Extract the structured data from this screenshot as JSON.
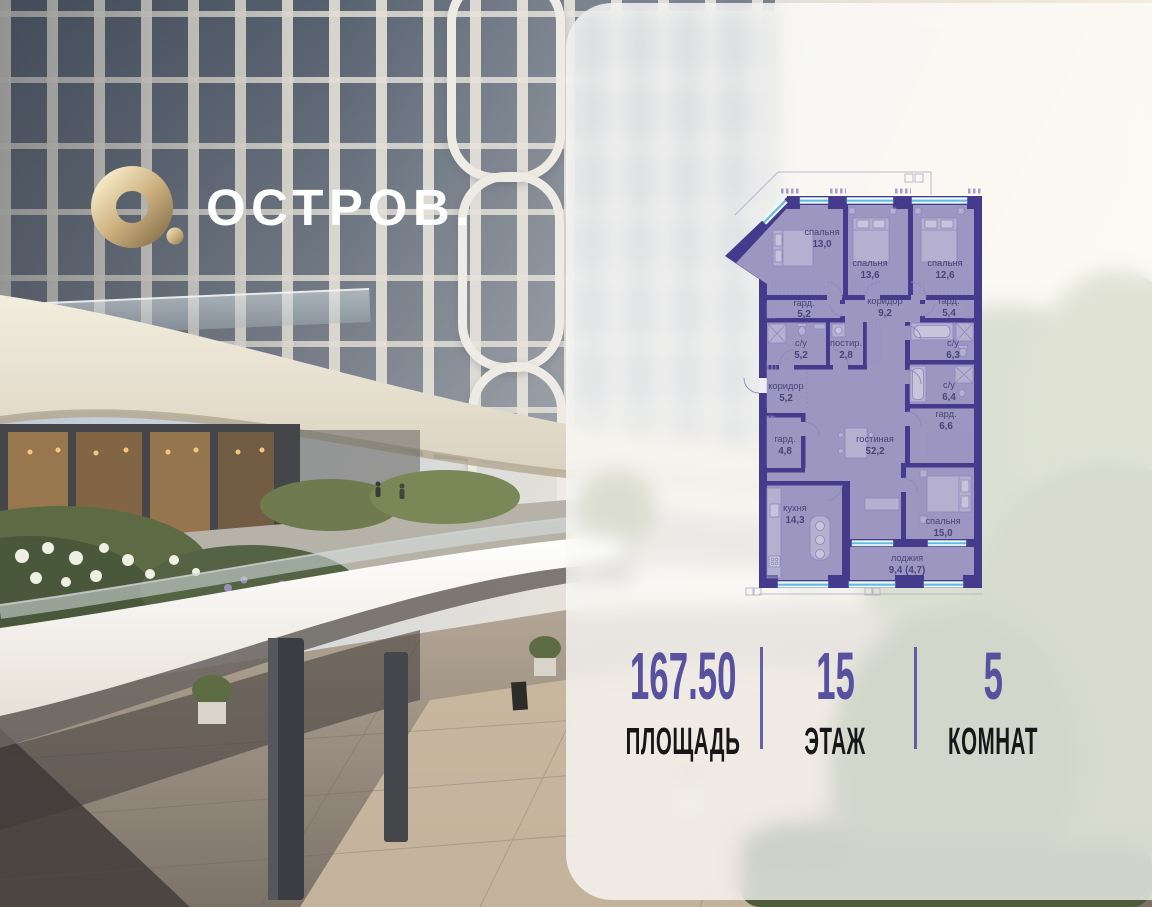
{
  "logo": {
    "wordmark": "ОСТРОВ.",
    "mark": "gold-ring-with-dot",
    "gold_color": "#c9ab72",
    "text_color": "#ffffff"
  },
  "floorplan": {
    "colors": {
      "wall": "#453a8b",
      "window": "#5fbce2",
      "label": "#4a4479"
    },
    "rooms": [
      {
        "name": "спальня",
        "area": "13,0"
      },
      {
        "name": "спальня",
        "area": "13,6"
      },
      {
        "name": "спальня",
        "area": "12,6"
      },
      {
        "name": "гард.",
        "area": "5,2"
      },
      {
        "name": "коридор",
        "area": "9,2"
      },
      {
        "name": "гард.",
        "area": "5,4"
      },
      {
        "name": "с/у",
        "area": "5,2"
      },
      {
        "name": "постир.",
        "area": "2,8"
      },
      {
        "name": "с/у",
        "area": "6,3"
      },
      {
        "name": "коридор",
        "area": "5,2"
      },
      {
        "name": "с/у",
        "area": "6,4"
      },
      {
        "name": "гард.",
        "area": "6,6"
      },
      {
        "name": "гард.",
        "area": "4,8"
      },
      {
        "name": "гостиная",
        "area": "52,2"
      },
      {
        "name": "кухня",
        "area": "14,3"
      },
      {
        "name": "спальня",
        "area": "15,0"
      },
      {
        "name": "лоджия",
        "area": "9,4 (4,7)"
      }
    ]
  },
  "stats": {
    "accent_color": "#57519f",
    "items": [
      {
        "value": "167.50",
        "label": "ПЛОЩАДЬ"
      },
      {
        "value": "15",
        "label": "ЭТАЖ"
      },
      {
        "value": "5",
        "label": "КОМНАТ"
      }
    ]
  }
}
